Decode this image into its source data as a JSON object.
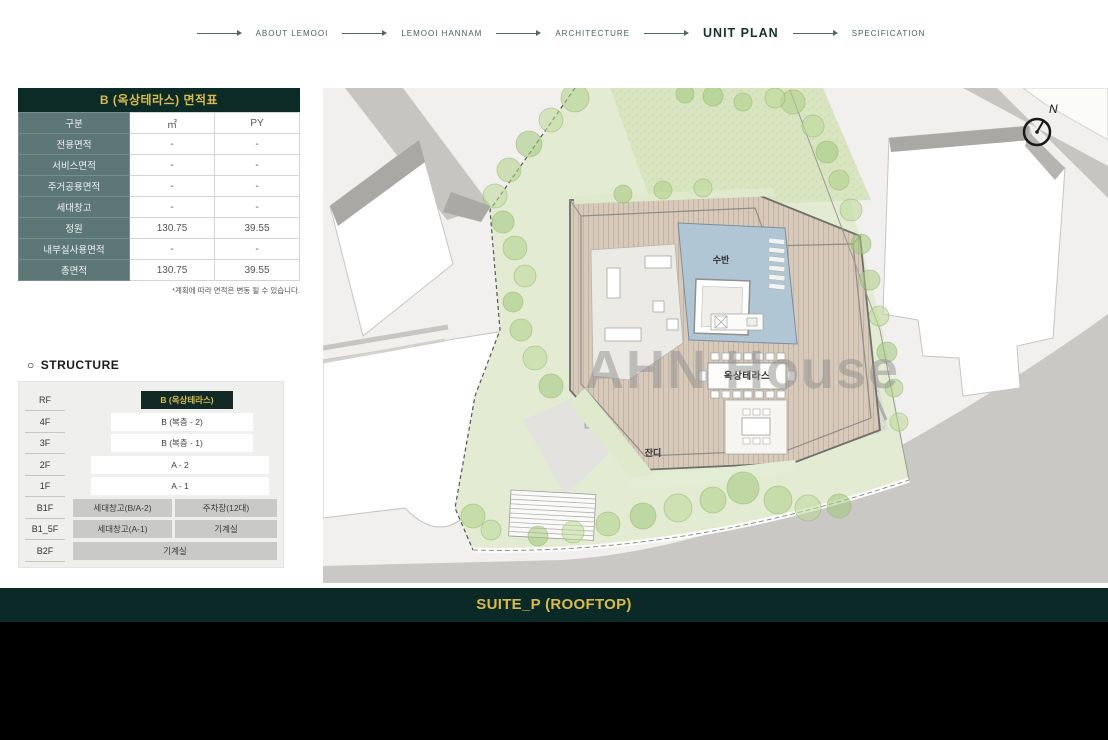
{
  "nav": {
    "items": [
      {
        "label": "ABOUT LEMOOI",
        "active": false
      },
      {
        "label": "LEMOOI HANNAM",
        "active": false
      },
      {
        "label": "ARCHITECTURE",
        "active": false
      },
      {
        "label": "UNIT PLAN",
        "active": true
      },
      {
        "label": "SPECIFICATION",
        "active": false
      }
    ]
  },
  "area_table": {
    "title": "B (옥상테라스) 면적표",
    "rows": [
      [
        "구분",
        "㎡",
        "PY"
      ],
      [
        "전용면적",
        "-",
        "-"
      ],
      [
        "서비스면적",
        "-",
        "-"
      ],
      [
        "주거공용면적",
        "-",
        "-"
      ],
      [
        "세대창고",
        "-",
        "-"
      ],
      [
        "정원",
        "130.75",
        "39.55"
      ],
      [
        "내부실사용면적",
        "-",
        "-"
      ],
      [
        "총면적",
        "130.75",
        "39.55"
      ]
    ],
    "footnote": "*계획에 따라 면적은 변동 될 수 있습니다."
  },
  "structure": {
    "marker": "○",
    "heading": "STRUCTURE",
    "floors": [
      {
        "label": "RF",
        "boxes": [
          "B (옥상테라스)"
        ]
      },
      {
        "label": "4F",
        "boxes": [
          "B (복층 - 2)"
        ]
      },
      {
        "label": "3F",
        "boxes": [
          "B (복층 - 1)"
        ]
      },
      {
        "label": "2F",
        "boxes": [
          "A - 2"
        ]
      },
      {
        "label": "1F",
        "boxes": [
          "A - 1"
        ]
      },
      {
        "label": "B1F",
        "boxes": [
          "세대창고(B/A-2)",
          "주차장(12대)"
        ]
      },
      {
        "label": "B1_5F",
        "boxes": [
          "세대창고(A-1)",
          "기계실"
        ]
      },
      {
        "label": "B2F",
        "boxes": [
          "기계실"
        ]
      }
    ]
  },
  "plan": {
    "labels": {
      "pool": "수반",
      "terrace": "옥상테라스",
      "lawn": "잔디"
    },
    "compass_label": "N",
    "watermark": "AHN House"
  },
  "footer": {
    "title": "SUITE_P (ROOFTOP)"
  },
  "colors": {
    "dark_green": "#0c2a26",
    "accent_yellow": "#d9bb4e",
    "teal_cell": "#5d7777"
  }
}
